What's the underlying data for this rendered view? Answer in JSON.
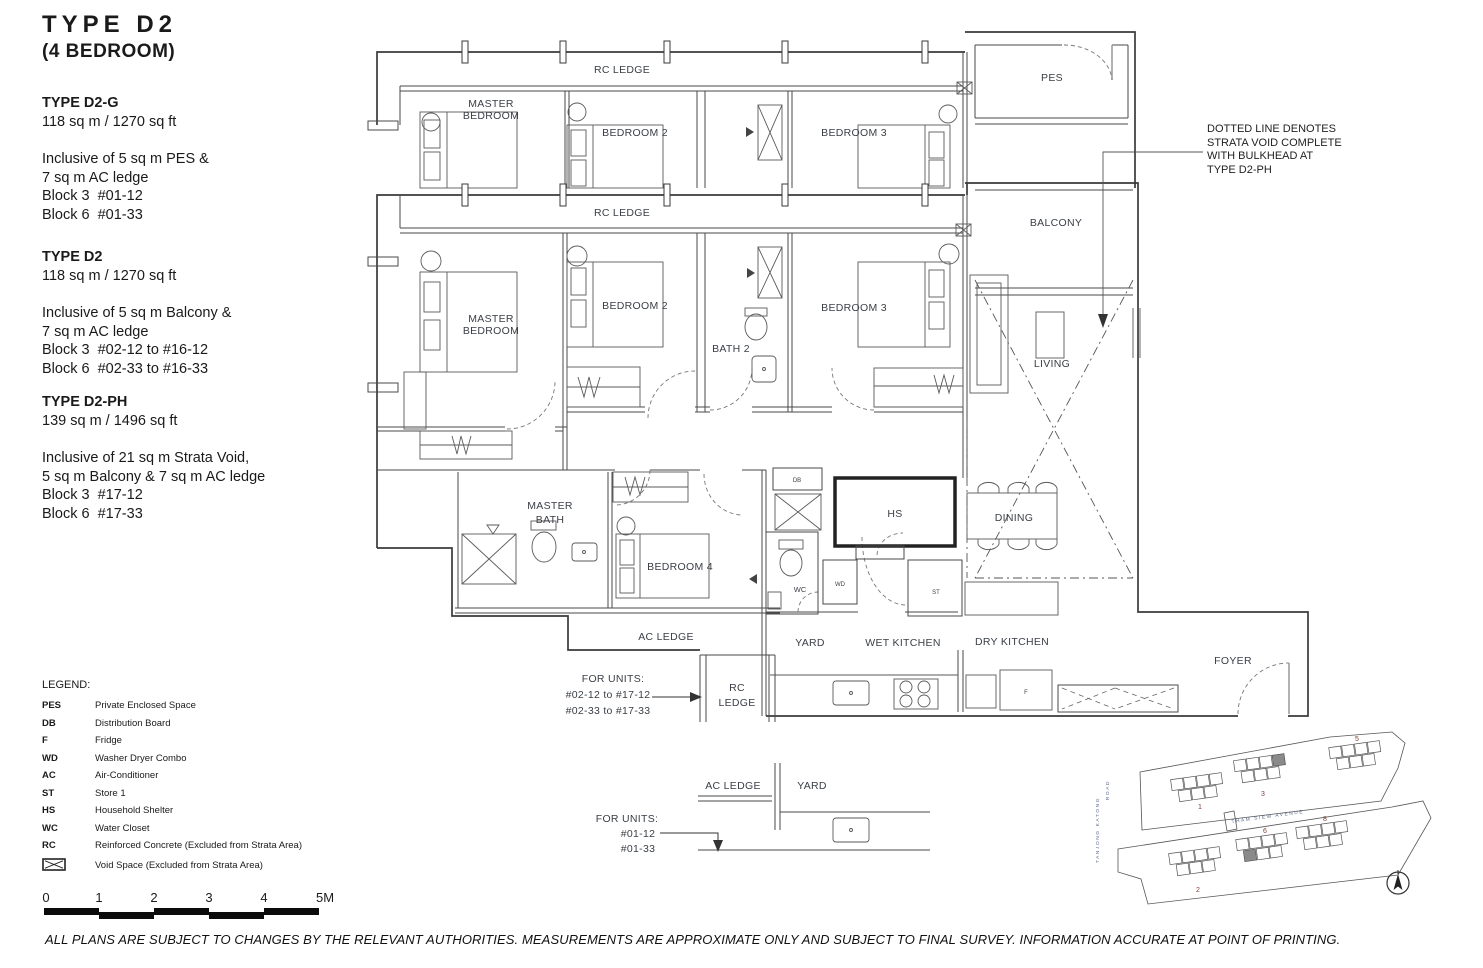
{
  "page": {
    "title": "TYPE  D2",
    "subtitle": "(4 BEDROOM)",
    "disclaimer": "ALL PLANS ARE SUBJECT TO CHANGES BY THE RELEVANT AUTHORITIES. MEASUREMENTS ARE APPROXIMATE ONLY AND SUBJECT TO FINAL SURVEY. INFORMATION ACCURATE AT POINT OF PRINTING."
  },
  "specs": [
    {
      "name": "TYPE D2-G",
      "area": "118 sq m / 1270 sq ft",
      "lines": [
        "Inclusive of 5 sq m PES &",
        "7 sq m AC ledge",
        "Block 3  #01-12",
        "Block 6  #01-33"
      ]
    },
    {
      "name": "TYPE D2",
      "area": "118 sq m / 1270 sq ft",
      "lines": [
        "Inclusive of 5 sq m Balcony &",
        "7 sq m AC ledge",
        "Block 3  #02-12 to #16-12",
        "Block 6  #02-33 to #16-33"
      ]
    },
    {
      "name": "TYPE D2-PH",
      "area": "139 sq m / 1496 sq ft",
      "lines": [
        "Inclusive of 21 sq m Strata Void,",
        "5 sq m Balcony & 7 sq m AC ledge",
        "Block 3  #17-12",
        "Block 6  #17-33"
      ]
    }
  ],
  "legend": {
    "title": "LEGEND:",
    "items": [
      {
        "abbr": "PES",
        "label": "Private Enclosed Space"
      },
      {
        "abbr": "DB",
        "label": "Distribution Board"
      },
      {
        "abbr": "F",
        "label": "Fridge"
      },
      {
        "abbr": "WD",
        "label": "Washer Dryer Combo"
      },
      {
        "abbr": "AC",
        "label": "Air-Conditioner"
      },
      {
        "abbr": "ST",
        "label": "Store 1"
      },
      {
        "abbr": "HS",
        "label": "Household Shelter"
      },
      {
        "abbr": "WC",
        "label": "Water Closet"
      },
      {
        "abbr": "RC",
        "label": "Reinforced Concrete (Excluded from Strata Area)"
      },
      {
        "abbr": "",
        "label": "Void Space (Excluded from Strata Area)"
      }
    ]
  },
  "scalebar": {
    "ticks": [
      "0",
      "1",
      "2",
      "3",
      "4",
      "5M"
    ]
  },
  "note": {
    "lines": [
      "DOTTED LINE DENOTES",
      "STRATA VOID COMPLETE",
      "WITH BULKHEAD AT",
      "TYPE D2-PH"
    ]
  },
  "plan": {
    "labels": {
      "rc_ledge": "RC LEDGE",
      "master_bedroom": [
        "MASTER",
        "BEDROOM"
      ],
      "bedroom2": "BEDROOM 2",
      "bedroom3": "BEDROOM 3",
      "bedroom4": "BEDROOM 4",
      "bath2": "BATH 2",
      "master_bath": [
        "MASTER",
        "BATH"
      ],
      "pes": "PES",
      "balcony": "BALCONY",
      "living": "LIVING",
      "dining": "DINING",
      "hs": "HS",
      "db": "DB",
      "wc": "WC",
      "wd": "WD",
      "st": "ST",
      "f": "F",
      "yard": "YARD",
      "wet_kitchen": "WET KITCHEN",
      "dry_kitchen": "DRY KITCHEN",
      "foyer": "FOYER",
      "ac_ledge": "AC LEDGE",
      "rc_ledge2": [
        "RC",
        "LEDGE"
      ]
    },
    "units_note_mid": [
      "FOR UNITS:",
      "#02-12 to #17-12",
      "#02-33 to #17-33"
    ],
    "units_note_bottom": [
      "FOR UNITS:",
      "#01-12",
      "#01-33"
    ]
  },
  "siteplan": {
    "road_left_1": "TANJONG KATONG",
    "road_left_2": "ROAD",
    "road_mid": "THAM SIEW AVENUE",
    "blocks": [
      "1",
      "3",
      "5",
      "2",
      "6",
      "8"
    ]
  },
  "colors": {
    "wall": "#3a3a3a",
    "label": "#3a3f46",
    "block_number": "#7d4038",
    "road_text": "#5a6a8a",
    "highlight_unit": "#8a8a8a",
    "scalebar": "#0b0b0b"
  }
}
